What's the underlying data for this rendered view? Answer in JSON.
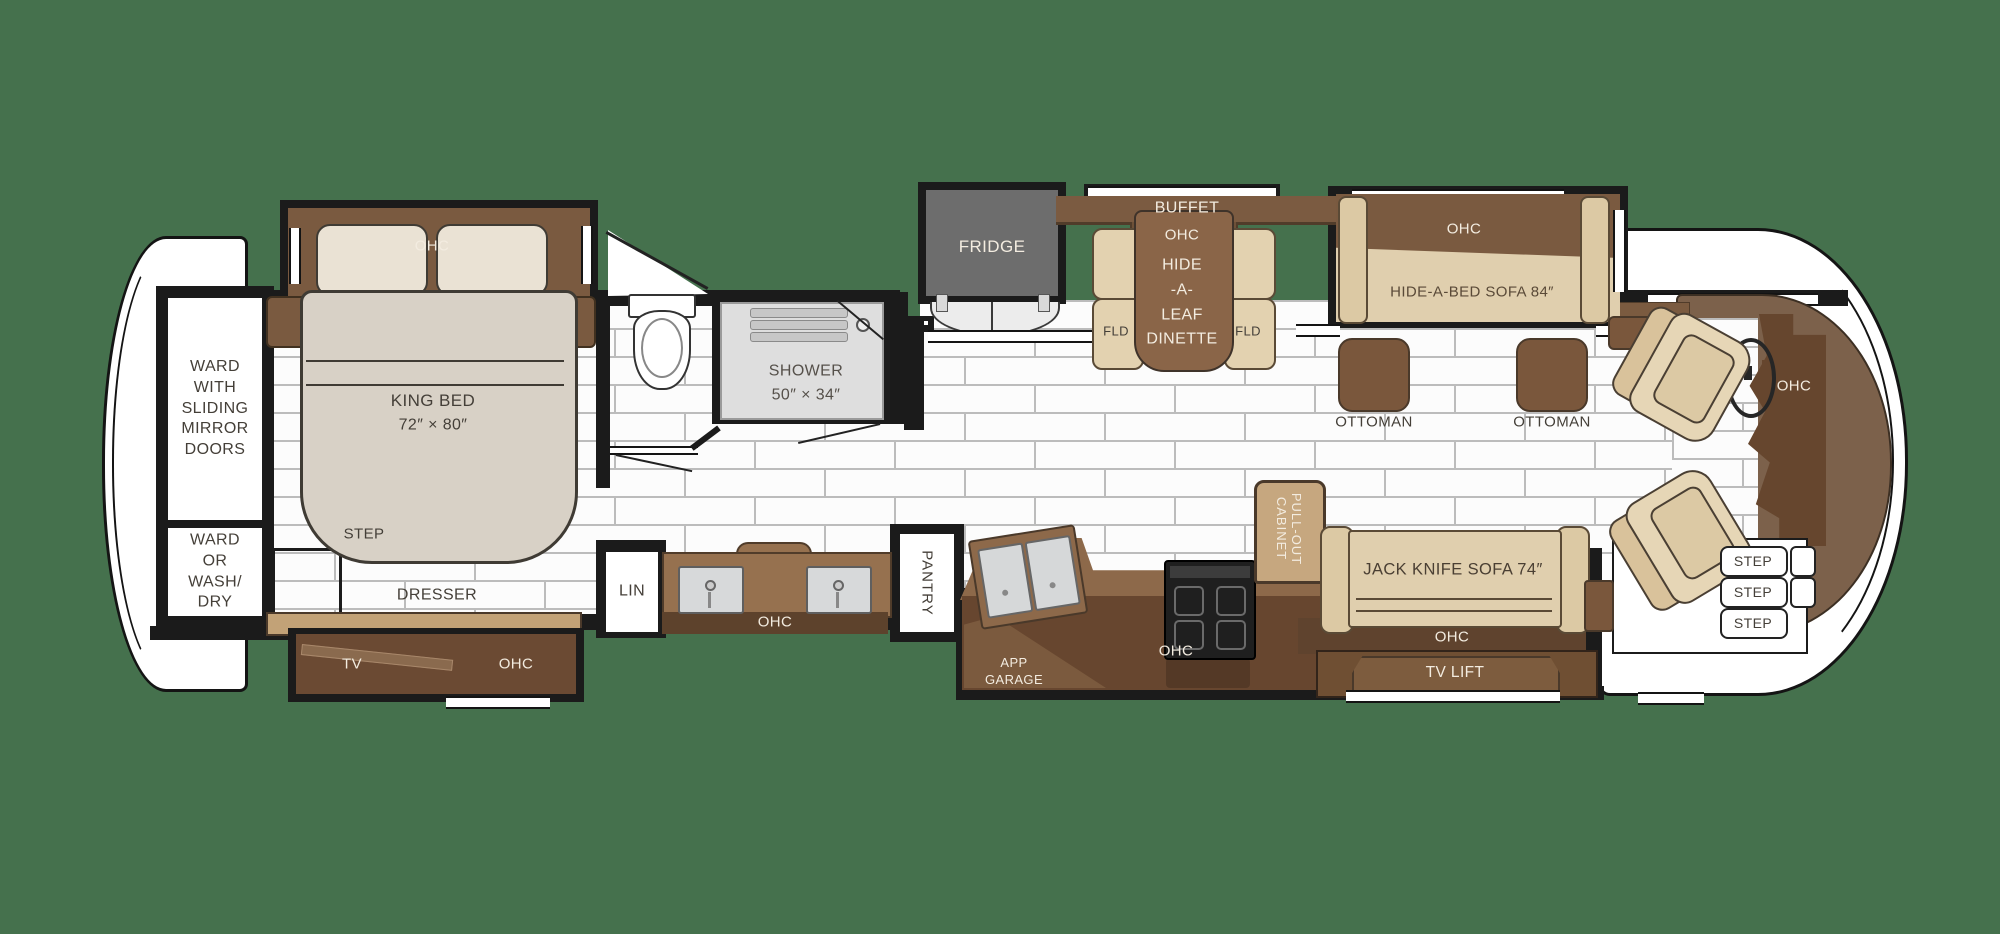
{
  "labels": {
    "ward_sliding": "WARD\nWITH\nSLIDING\nMIRROR\nDOORS",
    "ward_washdry": "WARD\nOR\nWASH/\nDRY",
    "bed_ohc": "OHC",
    "king_bed": "KING BED",
    "king_bed_size": "72″ × 80″",
    "step_bedroom": "STEP",
    "dresser": "DRESSER",
    "dresser_tv": "TV",
    "dresser_ohc": "OHC",
    "lin": "LIN",
    "vanity_ohc": "OHC",
    "pantry": "PANTRY",
    "shower": "SHOWER",
    "shower_size": "50″ × 34″",
    "fridge": "FRIDGE",
    "buffet": "BUFFET",
    "buffet_ohc": "OHC",
    "dinette": "HIDE\n-A-\nLEAF\nDINETTE",
    "fld_left": "FLD",
    "fld_right": "FLD",
    "sofa_ohc": "OHC",
    "hide_a_bed_sofa": "HIDE-A-BED SOFA 84″",
    "ottoman_left": "OTTOMAN",
    "ottoman_right": "OTTOMAN",
    "cockpit_ohc": "OHC",
    "app_garage": "APP\nGARAGE",
    "kitchen_ohc": "OHC",
    "pullout_cabinet": "PULL-OUT\nCABINET",
    "jack_knife_sofa": "JACK KNIFE SOFA 74″",
    "living_ohc": "OHC",
    "tv_lift": "TV LIFT",
    "step_1": "STEP",
    "step_2": "STEP",
    "step_3": "STEP"
  },
  "colors": {
    "background": "#45714d",
    "wall": "#1b1b1b",
    "tile": "#fcfcfc",
    "tile_grout": "#bcbcbc",
    "cabinet_brown": "#7b5b41",
    "dark_cabinet": "#5f432e",
    "counter_brown": "#8d694a",
    "kitchen_dark": "#67462f",
    "upholstery_tan": "#e0cfae",
    "slide_trim_tan": "#c2a277",
    "mattress": "#d8d1c6",
    "fridge_gray": "#6d6d6d",
    "shower_gray": "#dedede",
    "table_brown": "#8a6548",
    "ottoman_brown": "#7a573c",
    "cockpit_brown": "#7c614b",
    "dash_brown": "#66462e"
  }
}
